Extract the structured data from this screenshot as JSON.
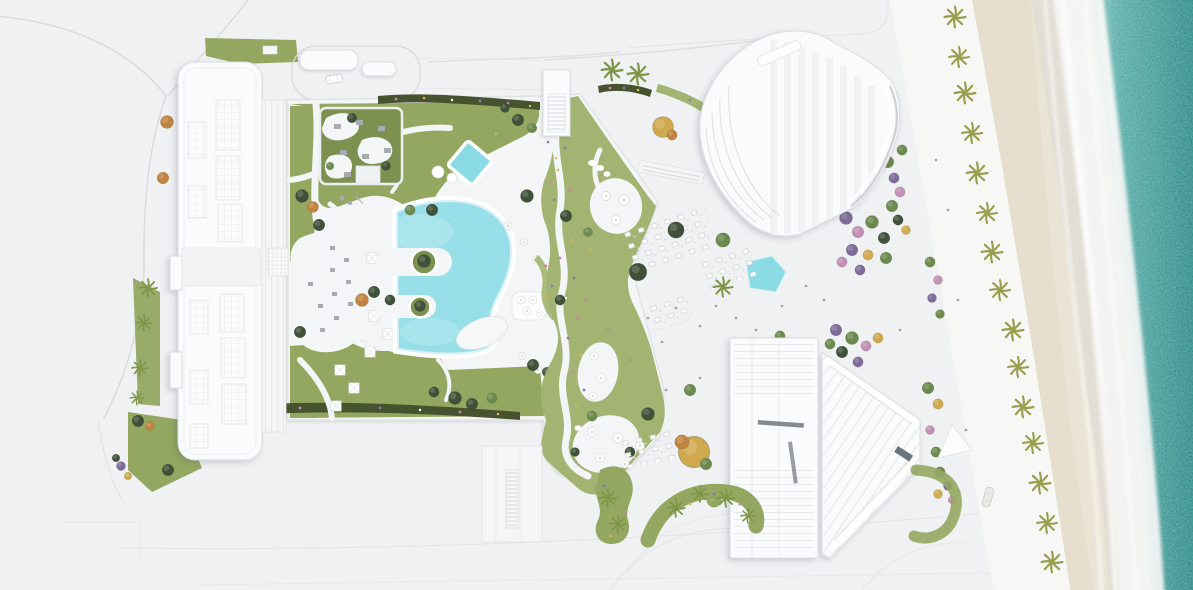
{
  "meta": {
    "scene_label": "Aerial architectural rendering of a beachfront resort masterplan"
  },
  "regions": {
    "site": "Aerial masterplan of beachfront resort",
    "access_roads": "Access roads north-west",
    "left_building": "West residential slab building with skylight roof",
    "entry_drop_off": "Entry drop-off loop with canopies and car",
    "podium": "Landscaped podium deck with lawns and walkways",
    "roof_garden": "Roof garden terrace with seating mats",
    "west_terrace": "Umbrella lounge terrace",
    "main_pool": "Free-form turquoise swimming pool",
    "kids_pool": "Small diamond kids pool",
    "pool_islands": "Planted circular pool islands",
    "sun_deck": "Pool sun deck with parasols and spa circles",
    "ribbon_garden": "Winding spa garden ribbon with patios and flowers",
    "plaza": "Event plaza with scattered trees",
    "pond": "Plaza reflecting pond",
    "dining": "Outdoor dining table clusters",
    "north_tower": "North fan-shaped tower",
    "south_tower": "South arrow-shaped tower",
    "bridge": "Link bridge to north tower",
    "planters": "Curved planters with palms",
    "gardens": "Mixed flowering tree gardens",
    "promenade": "Beach promenade",
    "palm_row": "Row of beach palms",
    "beach": "Sand beach",
    "surf": "Surf foam line",
    "ocean": "Teal ocean water"
  },
  "colors": {
    "ground": "#f0f1f2",
    "road_line": "#d7d9db",
    "curb_line": "#e0e2e4",
    "promenade": "#f7f7f6",
    "deck": "#f4f5f6",
    "deck_line": "#dfe1e3",
    "building": "#fafbfc",
    "building_line": "#dcdee1",
    "stripe": "#eceef0",
    "dark_glass": "#6d757c",
    "lawn": "#94a761",
    "lawn_light": "#a3b472",
    "lawn_dark": "#7c9150",
    "hedge": "#47532f",
    "tree_dark": "#3f5138",
    "tree_mid": "#6d8a4e",
    "tree_light": "#8fa75f",
    "tree_yellow": "#cfa94e",
    "tree_orange": "#c08440",
    "tree_pink": "#c38fb4",
    "tree_purple": "#7f6b99",
    "palm": "#7f9648",
    "palm_beach": "#98a04f",
    "flower_pink": "#d27fb0",
    "flower_purple": "#8f77ab",
    "flower_yellow": "#d8b84f",
    "pool": "#8bdbe6",
    "pool_shallow": "#b8ecf2",
    "pool_line": "#d8f2f5",
    "furniture": "#a7abaf",
    "furniture_line": "#c3c6ca",
    "sand": "#e5ddcb",
    "sand_wet": "#d8d3c9",
    "foam": "#f4f5f4",
    "ocean": "#4da7a2",
    "ocean_deep": "#1f837f",
    "shadow": "#3c4654"
  }
}
